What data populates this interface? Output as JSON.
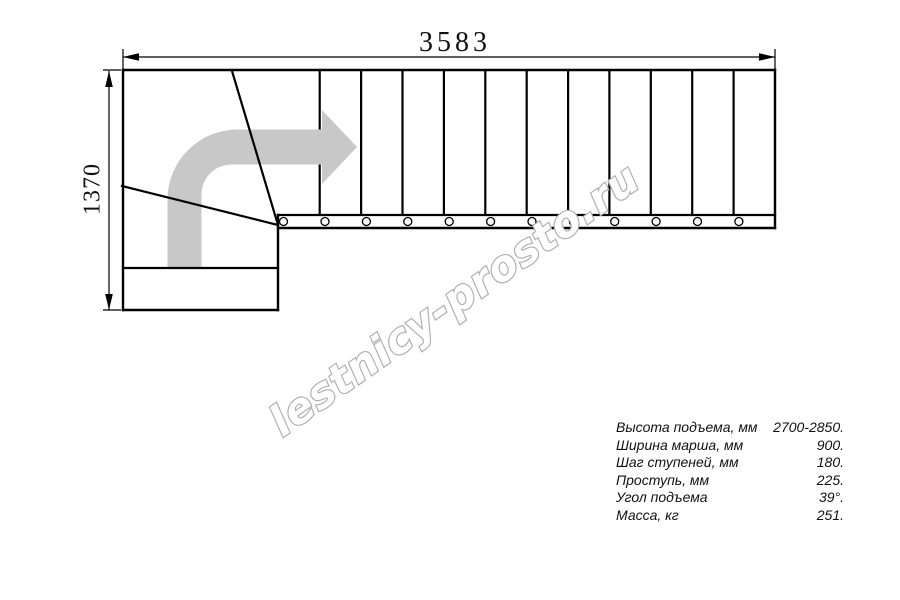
{
  "drawing": {
    "dim_width_label": "3583",
    "dim_height_label": "1370",
    "watermark": "lestnicy-prosto.ru"
  },
  "colors": {
    "line": "#000000",
    "arrow_gray": "#c8c8c8",
    "watermark_outline": "#b0b0b0",
    "watermark_fill": "#ffffff"
  },
  "specs": {
    "rows": [
      {
        "label": "Высота подъема, мм",
        "value": "2700-2850."
      },
      {
        "label": "Ширина марша, мм",
        "value": "900."
      },
      {
        "label": "Шаг ступеней, мм",
        "value": "180."
      },
      {
        "label": "Проступь, мм",
        "value": "225."
      },
      {
        "label": "Угол подъема",
        "value": "39°."
      },
      {
        "label": "Масса, кг",
        "value": "251."
      }
    ]
  }
}
